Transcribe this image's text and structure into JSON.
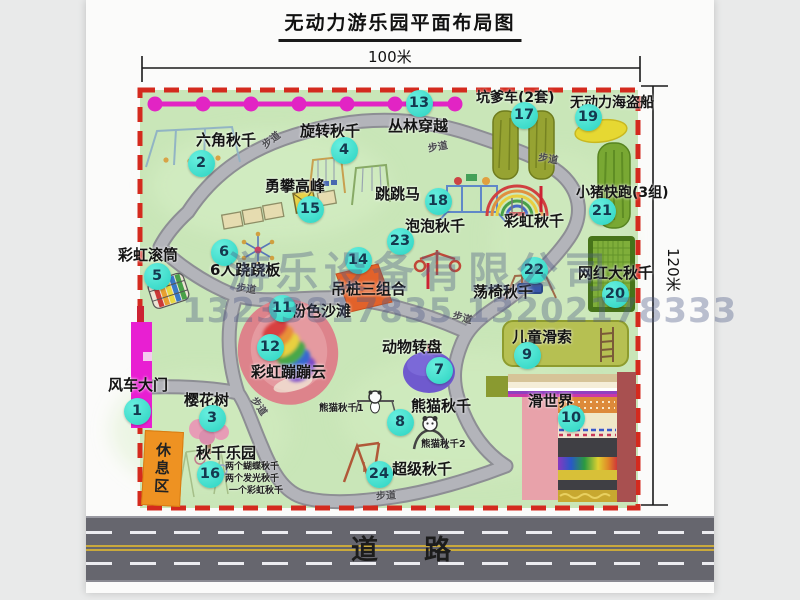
{
  "title": "无动力游乐园平面布局图",
  "dimensions": {
    "width_label": "100米",
    "height_label": "120米"
  },
  "watermark": {
    "company": "游乐设备有限公司",
    "phone": "13233817835 13202178333"
  },
  "road": {
    "label": "道路"
  },
  "colors": {
    "map_green": "#c9e6b8",
    "border_red": "#d42a1e",
    "badge_cyan": "#2bd3c1",
    "zipline_magenta": "#e224c4",
    "road_gray": "#66666e",
    "rest_orange": "#ee9222",
    "gate_magenta": "#e81fd2"
  },
  "map": {
    "rest_area_label": "休息区",
    "path_label": "步道",
    "path_labels": [
      {
        "x": 262,
        "y": 136,
        "r": -38
      },
      {
        "x": 428,
        "y": 143,
        "r": -10
      },
      {
        "x": 538,
        "y": 155,
        "r": 10
      },
      {
        "x": 236,
        "y": 285,
        "r": 8
      },
      {
        "x": 452,
        "y": 314,
        "r": 16
      },
      {
        "x": 376,
        "y": 492,
        "r": -3
      },
      {
        "x": 248,
        "y": 402,
        "r": 55
      }
    ],
    "features": [
      {
        "num": 1,
        "name": "windmill-gate",
        "label": "风车大门",
        "lx": 108,
        "ly": 378,
        "ls": 15,
        "bx": 137,
        "by": 411
      },
      {
        "num": 2,
        "name": "hexagon-swing",
        "label": "六角秋千",
        "lx": 196,
        "ly": 133,
        "ls": 15,
        "bx": 201,
        "by": 163
      },
      {
        "num": 3,
        "name": "cherry-tree",
        "label": "樱花树",
        "lx": 184,
        "ly": 393,
        "ls": 15,
        "bx": 212,
        "by": 418
      },
      {
        "num": 4,
        "name": "rotating-swing",
        "label": "旋转秋千",
        "lx": 300,
        "ly": 124,
        "ls": 15,
        "bx": 344,
        "by": 150
      },
      {
        "num": 5,
        "name": "rainbow-roller",
        "label": "彩虹滚筒",
        "lx": 118,
        "ly": 248,
        "ls": 15,
        "bx": 157,
        "by": 276
      },
      {
        "num": 6,
        "name": "six-person-seesaw",
        "label": "6人跷跷板",
        "lx": 210,
        "ly": 263,
        "ls": 15,
        "bx": 224,
        "by": 252
      },
      {
        "num": 7,
        "name": "animal-turntable",
        "label": "动物转盘",
        "lx": 382,
        "ly": 340,
        "ls": 15,
        "bx": 439,
        "by": 370
      },
      {
        "num": 8,
        "name": "panda-swing",
        "label": "熊猫秋千",
        "lx": 411,
        "ly": 399,
        "ls": 15,
        "bx": 400,
        "by": 422
      },
      {
        "num": 9,
        "name": "kids-zipline",
        "label": "儿童滑索",
        "lx": 512,
        "ly": 330,
        "ls": 15,
        "bx": 527,
        "by": 355
      },
      {
        "num": 10,
        "name": "slide-world",
        "label": "滑世界",
        "lx": 528,
        "ly": 394,
        "ls": 15,
        "bx": 571,
        "by": 418
      },
      {
        "num": 11,
        "name": "pink-beach",
        "label": "粉色沙滩",
        "lx": 291,
        "ly": 304,
        "ls": 15,
        "bx": 282,
        "by": 308
      },
      {
        "num": 12,
        "name": "rainbow-bounce-cloud",
        "label": "彩虹蹦蹦云",
        "lx": 251,
        "ly": 365,
        "ls": 15,
        "bx": 270,
        "by": 347
      },
      {
        "num": 13,
        "name": "jungle-crossing",
        "label": "丛林穿越",
        "lx": 388,
        "ly": 119,
        "ls": 15,
        "bx": 419,
        "by": 103
      },
      {
        "num": 14,
        "name": "hanging-pile-combo",
        "label": "吊桩三组合",
        "lx": 331,
        "ly": 282,
        "ls": 15,
        "bx": 358,
        "by": 260
      },
      {
        "num": 15,
        "name": "climb-peak",
        "label": "勇攀高峰",
        "lx": 265,
        "ly": 179,
        "ls": 15,
        "bx": 310,
        "by": 209
      },
      {
        "num": 16,
        "name": "swing-park",
        "label": "秋千乐园",
        "lx": 196,
        "ly": 446,
        "ls": 15,
        "bx": 210,
        "by": 474
      },
      {
        "num": 17,
        "name": "pit-car",
        "label": "坑爹车(2套)",
        "lx": 476,
        "ly": 91,
        "ls": 14,
        "bx": 524,
        "by": 115
      },
      {
        "num": 18,
        "name": "jumping-horse",
        "label": "跳跳马",
        "lx": 375,
        "ly": 187,
        "ls": 15,
        "bx": 438,
        "by": 201
      },
      {
        "num": 19,
        "name": "pirate-ship",
        "label": "无动力海盗船",
        "lx": 570,
        "ly": 96,
        "ls": 14,
        "bx": 588,
        "by": 117
      },
      {
        "num": 20,
        "name": "famous-big-swing",
        "label": "网红大秋千",
        "lx": 578,
        "ly": 266,
        "ls": 15,
        "bx": 615,
        "by": 294
      },
      {
        "num": 21,
        "name": "piggy-run",
        "label": "小猪快跑(3组)",
        "lx": 576,
        "ly": 186,
        "ls": 14,
        "bx": 602,
        "by": 211
      },
      {
        "num": 22,
        "name": "chair-swing",
        "label": "荡椅秋千",
        "lx": 473,
        "ly": 285,
        "ls": 15,
        "bx": 534,
        "by": 270
      },
      {
        "num": 23,
        "name": "bubble-swing",
        "label": "泡泡秋千",
        "lx": 405,
        "ly": 219,
        "ls": 15,
        "bx": 400,
        "by": 241
      },
      {
        "num": 24,
        "name": "super-swing",
        "label": "超级秋千",
        "lx": 392,
        "ly": 462,
        "ls": 15,
        "bx": 379,
        "by": 474
      },
      {
        "num": null,
        "name": "rainbow-swing",
        "label": "彩虹秋千",
        "lx": 504,
        "ly": 214,
        "ls": 15
      }
    ],
    "sub_labels": [
      {
        "text": "熊猫秋千1",
        "x": 319,
        "y": 404,
        "s": 9.5
      },
      {
        "text": "熊猫秋千2",
        "x": 421,
        "y": 440,
        "s": 9.5
      },
      {
        "text": "两个蝴蝶秋千",
        "x": 225,
        "y": 463,
        "s": 9
      },
      {
        "text": "两个发光秋千",
        "x": 225,
        "y": 475,
        "s": 9
      },
      {
        "text": "一个彩虹秋千",
        "x": 229,
        "y": 487,
        "s": 9
      }
    ]
  }
}
